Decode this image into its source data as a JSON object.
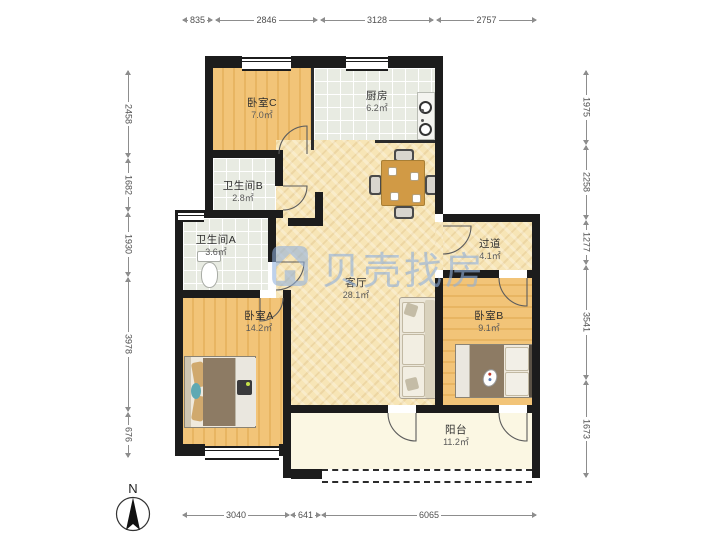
{
  "watermark": {
    "text": "贝壳找房"
  },
  "compass": {
    "label": "N"
  },
  "dims": {
    "top": [
      "835",
      "2846",
      "3128",
      "2757"
    ],
    "bottom": [
      "3040",
      "641",
      "6065"
    ],
    "left": [
      "2458",
      "1682",
      "1930",
      "3978",
      "676"
    ],
    "right": [
      "1975",
      "2258",
      "1277",
      "3541",
      "1673"
    ]
  },
  "rooms": {
    "bedroomC": {
      "name": "卧室C",
      "area": "7.0㎡"
    },
    "kitchen": {
      "name": "厨房",
      "area": "6.2㎡"
    },
    "bathB": {
      "name": "卫生间B",
      "area": "2.8㎡"
    },
    "bathA": {
      "name": "卫生间A",
      "area": "3.6㎡"
    },
    "bedroomA": {
      "name": "卧室A",
      "area": "14.2㎡"
    },
    "living": {
      "name": "客厅",
      "area": "28.1㎡"
    },
    "hallway": {
      "name": "过道",
      "area": "4.1㎡"
    },
    "bedroomB": {
      "name": "卧室B",
      "area": "9.1㎡"
    },
    "balcony": {
      "name": "阳台",
      "area": "11.2㎡"
    }
  },
  "colors": {
    "wall": "#1c1c1c",
    "bedroom_floor": "#f2c478",
    "living_floor": "#f7e5b6",
    "tile_floor": "#e8ebe2",
    "watermark_blue": "#8fb0dc"
  }
}
